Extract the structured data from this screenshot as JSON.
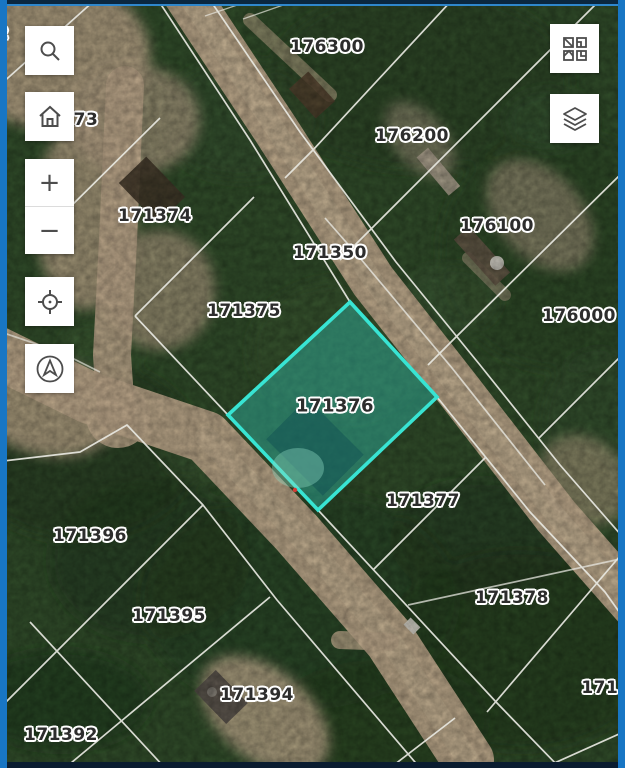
{
  "map": {
    "title": "parcel-map-viewer",
    "frame_colors": {
      "side_border": "#1876c4",
      "top_border": "#0a2740",
      "top_accent": "#2f87cc",
      "bottom_border": "#0a1c30"
    },
    "highlight": {
      "parcel_id": "171376",
      "points": "350,302 437,397 318,510 228,415",
      "stroke": "#38e4d3",
      "fill": "rgba(47,206,192,0.38)"
    },
    "labels": [
      {
        "text": "2",
        "x": 3,
        "y": 34
      },
      {
        "text": "73",
        "x": 86,
        "y": 120
      },
      {
        "text": "176300",
        "x": 327,
        "y": 47
      },
      {
        "text": "176200",
        "x": 412,
        "y": 136
      },
      {
        "text": "176100",
        "x": 497,
        "y": 226
      },
      {
        "text": "176000",
        "x": 579,
        "y": 316
      },
      {
        "text": "171374",
        "x": 155,
        "y": 216
      },
      {
        "text": "171350",
        "x": 330,
        "y": 253
      },
      {
        "text": "171375",
        "x": 244,
        "y": 311
      },
      {
        "text": "171376",
        "x": 335,
        "y": 406,
        "size": 18
      },
      {
        "text": "171377",
        "x": 423,
        "y": 501
      },
      {
        "text": "171396",
        "x": 90,
        "y": 536
      },
      {
        "text": "171395",
        "x": 169,
        "y": 616
      },
      {
        "text": "171378",
        "x": 512,
        "y": 598
      },
      {
        "text": "1713",
        "x": 606,
        "y": 688
      },
      {
        "text": "171394",
        "x": 257,
        "y": 695
      },
      {
        "text": "171392",
        "x": 61,
        "y": 735
      }
    ],
    "controls": {
      "zoom_in": "+",
      "zoom_out": "−",
      "left_buttons": [
        "search",
        "home",
        "zoom-in",
        "zoom-out",
        "locate",
        "compass"
      ],
      "right_buttons": [
        "basemap-gallery",
        "layers"
      ]
    }
  }
}
